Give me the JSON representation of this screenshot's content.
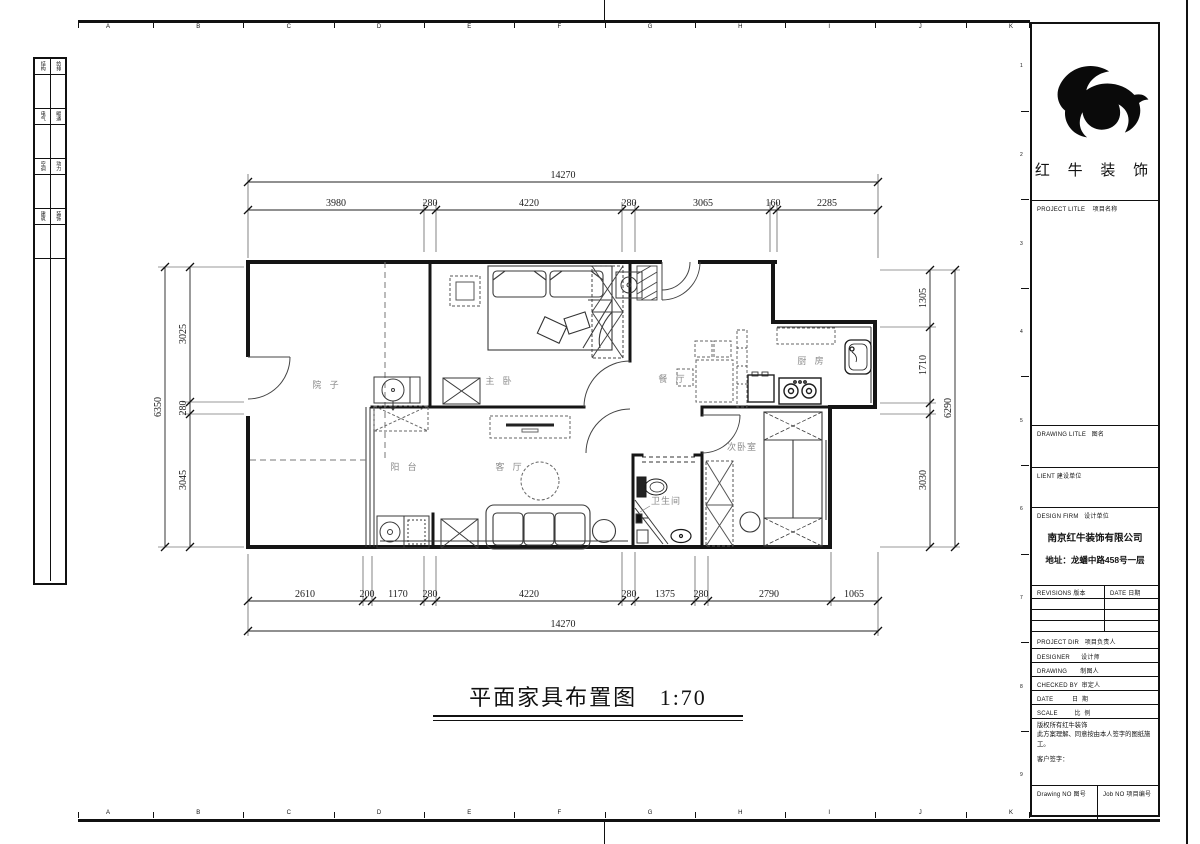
{
  "sheet": {
    "ruler_letters": [
      "A",
      "B",
      "C",
      "D",
      "E",
      "F",
      "G",
      "H",
      "I",
      "J",
      "K"
    ],
    "ruler_numbers": [
      "1",
      "2",
      "3",
      "4",
      "5",
      "6",
      "7",
      "8",
      "9"
    ],
    "left_table_rows": [
      [
        "结构",
        "给排"
      ],
      [
        "电气",
        "暖通"
      ],
      [
        "空调",
        "动力"
      ],
      [
        "建筑",
        "装饰"
      ]
    ]
  },
  "title_block": {
    "brand_name": "红 牛 装 饰",
    "project_title": "PROJECT LITLE    项目名称",
    "drawing_title": "DRAWING LITLE   图名",
    "client": "LIENT 建设单位",
    "design_firm": "DESIGN FIRM   设计单位",
    "firm_name": "南京红牛装饰有限公司",
    "firm_address": "地址：龙蟠中路458号一层",
    "revisions": "REVISIONS 版本",
    "date_col": "DATE 日期",
    "project_dir": "PROJECT DIR   项目负责人",
    "designer": "DESIGNER      设计师",
    "drafter": "DRAWING       制图人",
    "checked_by": "CHECKED BY  审定人",
    "date": "DATE          日  期",
    "scale": "SCALE         比  例",
    "copyright1": "版权所有红牛装饰",
    "copyright2": "此方案理解、同意按由本人签字的图纸施工。",
    "client_sign": "客户签字：",
    "drawing_no": "Drawing NO 图号",
    "job_no": "Job NO 项目编号"
  },
  "plan": {
    "title": "平面家具布置图",
    "scale": "1:70",
    "rooms": {
      "courtyard": "院 子",
      "balcony": "阳 台",
      "living": "客 厅",
      "master": "主 卧",
      "dining": "餐 厅",
      "kitchen": "厨 房",
      "bedroom2": "次卧室",
      "bathroom": "卫生间"
    },
    "dims": {
      "top_total": "14270",
      "top": [
        "3980",
        "280",
        "4220",
        "280",
        "3065",
        "160",
        "2285"
      ],
      "bottom": [
        "2610",
        "200",
        "1170",
        "280",
        "4220",
        "280",
        "1375",
        "280",
        "2790",
        "1065"
      ],
      "bottom_total": "14270",
      "left_total": "6350",
      "left": [
        "3025",
        "280",
        "3045"
      ],
      "right_total": "6290",
      "right": [
        "1305",
        "1710",
        "3030"
      ]
    }
  }
}
